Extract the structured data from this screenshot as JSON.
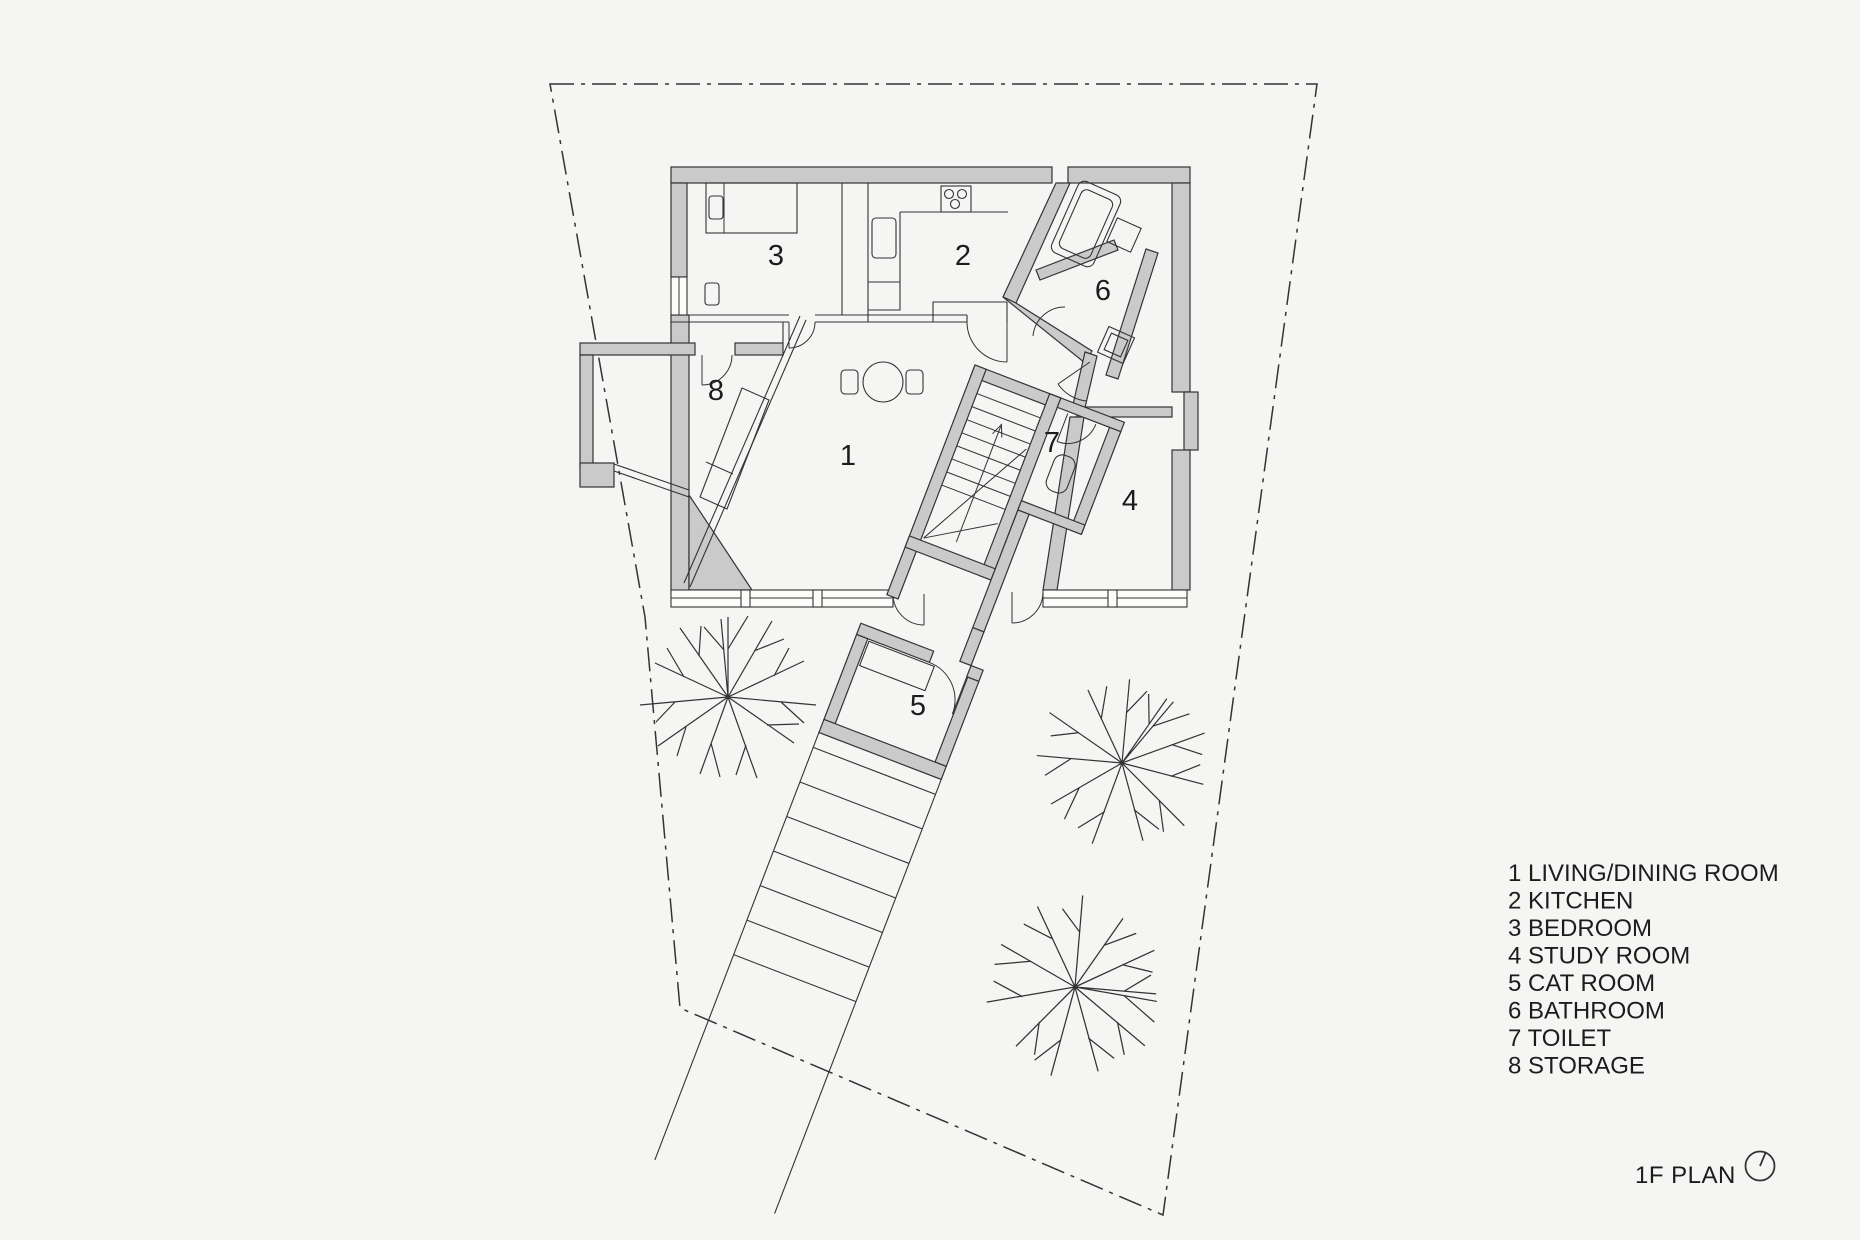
{
  "title": "1F PLAN",
  "rooms": [
    {
      "number": "1",
      "name": "LIVING/DINING ROOM",
      "label": "1 LIVING/DINING ROOM"
    },
    {
      "number": "2",
      "name": "KITCHEN",
      "label": "2 KITCHEN"
    },
    {
      "number": "3",
      "name": "BEDROOM",
      "label": "3 BEDROOM"
    },
    {
      "number": "4",
      "name": "STUDY ROOM",
      "label": "4 STUDY ROOM"
    },
    {
      "number": "5",
      "name": "CAT ROOM",
      "label": "5 CAT ROOM"
    },
    {
      "number": "6",
      "name": "BATHROOM",
      "label": "6 BATHROOM"
    },
    {
      "number": "7",
      "name": "TOILET",
      "label": "7 TOILET"
    },
    {
      "number": "8",
      "name": "STORAGE",
      "label": "8 STORAGE"
    }
  ],
  "icons": {
    "north": "north-arrow-icon"
  },
  "colors": {
    "background": "#f5f5f4",
    "wall_fill": "#cacaca",
    "line": "#333333",
    "text": "#1c1c1c"
  }
}
